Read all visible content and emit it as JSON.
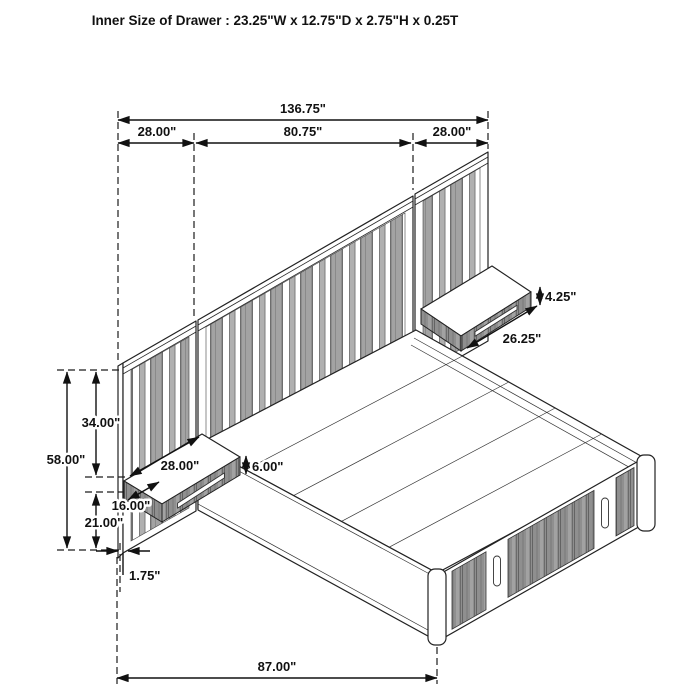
{
  "title": "Inner Size of Drawer : 23.25\"W x 12.75\"D x 2.75\"H x 0.25T",
  "dims": {
    "total_width": "136.75\"",
    "left_panel_width": "28.00\"",
    "center_panel_width": "80.75\"",
    "right_panel_width": "28.00\"",
    "right_shelf_height": "4.25\"",
    "right_shelf_width": "26.25\"",
    "upper_height": "34.00\"",
    "total_height": "58.00\"",
    "left_shelf_width": "28.00\"",
    "left_shelf_height": "6.00\"",
    "left_shelf_depth": "16.00\"",
    "base_height": "21.00\"",
    "panel_thickness": "1.75\"",
    "bed_length": "87.00\""
  },
  "colors": {
    "background": "#ffffff",
    "line": "#1c1c1c",
    "panel_stripe": "#9e9e9e",
    "drawer_face": "#8f8f8f"
  }
}
